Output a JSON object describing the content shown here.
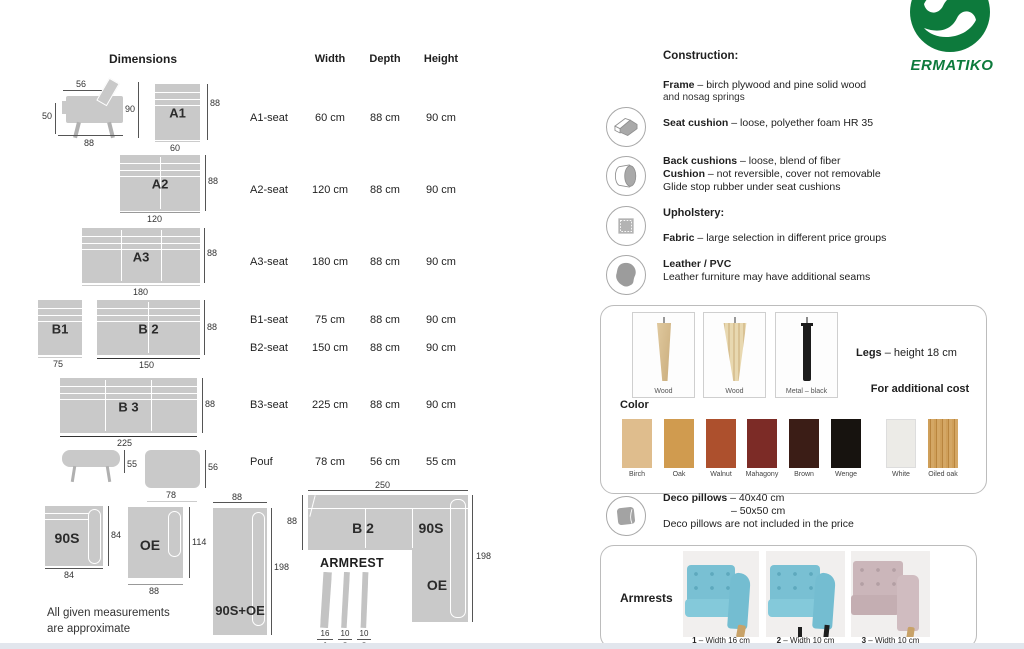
{
  "brand": {
    "name": "ERMATIKO",
    "green": "#0d7a3c"
  },
  "dimensions": {
    "title": "Dimensions",
    "table": {
      "headers": {
        "width": "Width",
        "depth": "Depth",
        "height": "Height"
      },
      "rows": [
        {
          "name": "A1-seat",
          "width": "60 cm",
          "depth": "88 cm",
          "height": "90 cm"
        },
        {
          "name": "A2-seat",
          "width": "120 cm",
          "depth": "88 cm",
          "height": "90 cm"
        },
        {
          "name": "A3-seat",
          "width": "180 cm",
          "depth": "88 cm",
          "height": "90 cm"
        },
        {
          "name": "B1-seat",
          "width": "75 cm",
          "depth": "88 cm",
          "height": "90 cm"
        },
        {
          "name": "B2-seat",
          "width": "150 cm",
          "depth": "88 cm",
          "height": "90 cm"
        },
        {
          "name": "B3-seat",
          "width": "225 cm",
          "depth": "88 cm",
          "height": "90 cm"
        },
        {
          "name": "Pouf",
          "width": "78 cm",
          "depth": "56 cm",
          "height": "55 cm"
        }
      ]
    },
    "note": [
      "All given measurements",
      "are approximate"
    ],
    "side_view": {
      "top": "56",
      "left": "50",
      "right": "90",
      "bottom": "88"
    },
    "modules": {
      "a1": {
        "label": "A1",
        "right": "88",
        "bottom": "60"
      },
      "a2": {
        "label": "A2",
        "right": "88",
        "bottom": "120"
      },
      "a3": {
        "label": "A3",
        "right": "88",
        "bottom": "180"
      },
      "b1": {
        "label": "B1",
        "bottom": "75"
      },
      "b2": {
        "label": "B 2",
        "right": "88",
        "bottom": "150"
      },
      "b3": {
        "label": "B 3",
        "right": "88",
        "bottom": "225"
      },
      "pouf_side": {
        "right": "55"
      },
      "pouf_top": {
        "right": "56",
        "bottom": "78"
      },
      "s90": {
        "label": "90S",
        "right": "84",
        "bottom": "84"
      },
      "oe": {
        "label": "OE",
        "right": "114",
        "bottom": "88"
      },
      "s90_oe": {
        "label": "90S+OE",
        "top": "88",
        "right": "198"
      }
    },
    "corner": {
      "top": "250",
      "left": "88",
      "right": "198",
      "label_b2": "B 2",
      "label_90s": "90S",
      "label_oe": "OE"
    },
    "armrest_diagram": {
      "title": "ARMREST",
      "strips": [
        {
          "width": "16",
          "num": "1"
        },
        {
          "width": "10",
          "num": "2"
        },
        {
          "width": "10",
          "num": "3"
        }
      ]
    }
  },
  "construction": {
    "title": "Construction:",
    "frame": {
      "bold": "Frame",
      "text": " – birch plywood and pine solid wood",
      "text2": "and nosag springs"
    },
    "seat": {
      "bold": "Seat cushion",
      "text": " – loose, polyether foam HR 35"
    },
    "back": {
      "bold": "Back cushions",
      "text": " – loose, blend of fiber"
    },
    "cushion": {
      "bold": "Cushion",
      "text": " – not reversible, cover not removable"
    },
    "glide": "Glide stop rubber under seat cushions",
    "upholstery_title": "Upholstery:",
    "fabric": {
      "bold": "Fabric",
      "text": " – large selection in different price groups"
    },
    "leather": {
      "bold": "Leather / PVC",
      "text": "Leather furniture may have additional seams"
    }
  },
  "legs": {
    "heading": {
      "bold": "Legs",
      "text": " – height 18 cm"
    },
    "options": [
      "Wood",
      "Wood",
      "Metal – black"
    ],
    "color_title": "Color",
    "additional_cost": "For additional cost",
    "swatches": [
      {
        "name": "Birch",
        "hex": "#dfbd8d"
      },
      {
        "name": "Oak",
        "hex": "#d09b4f"
      },
      {
        "name": "Walnut",
        "hex": "#ad502d"
      },
      {
        "name": "Mahagony",
        "hex": "#7c2b26"
      },
      {
        "name": "Brown",
        "hex": "#3b1d16"
      },
      {
        "name": "Wenge",
        "hex": "#17130f"
      },
      {
        "name": "White",
        "hex": "#ecebe7"
      },
      {
        "name": "Oiled oak",
        "hex": "#c99950"
      }
    ]
  },
  "pillows": {
    "bold": "Deco pillows",
    "size1": " – 40x40 cm",
    "size2": "– 50x50 cm",
    "note": "Deco pillows are not included in the price"
  },
  "armrests": {
    "title": "Armrests",
    "items": [
      {
        "num": "1",
        "text": " – Width 16 cm"
      },
      {
        "num": "2",
        "text": " – Width 10 cm"
      },
      {
        "num": "3",
        "text": " – Width 10 cm"
      }
    ]
  }
}
